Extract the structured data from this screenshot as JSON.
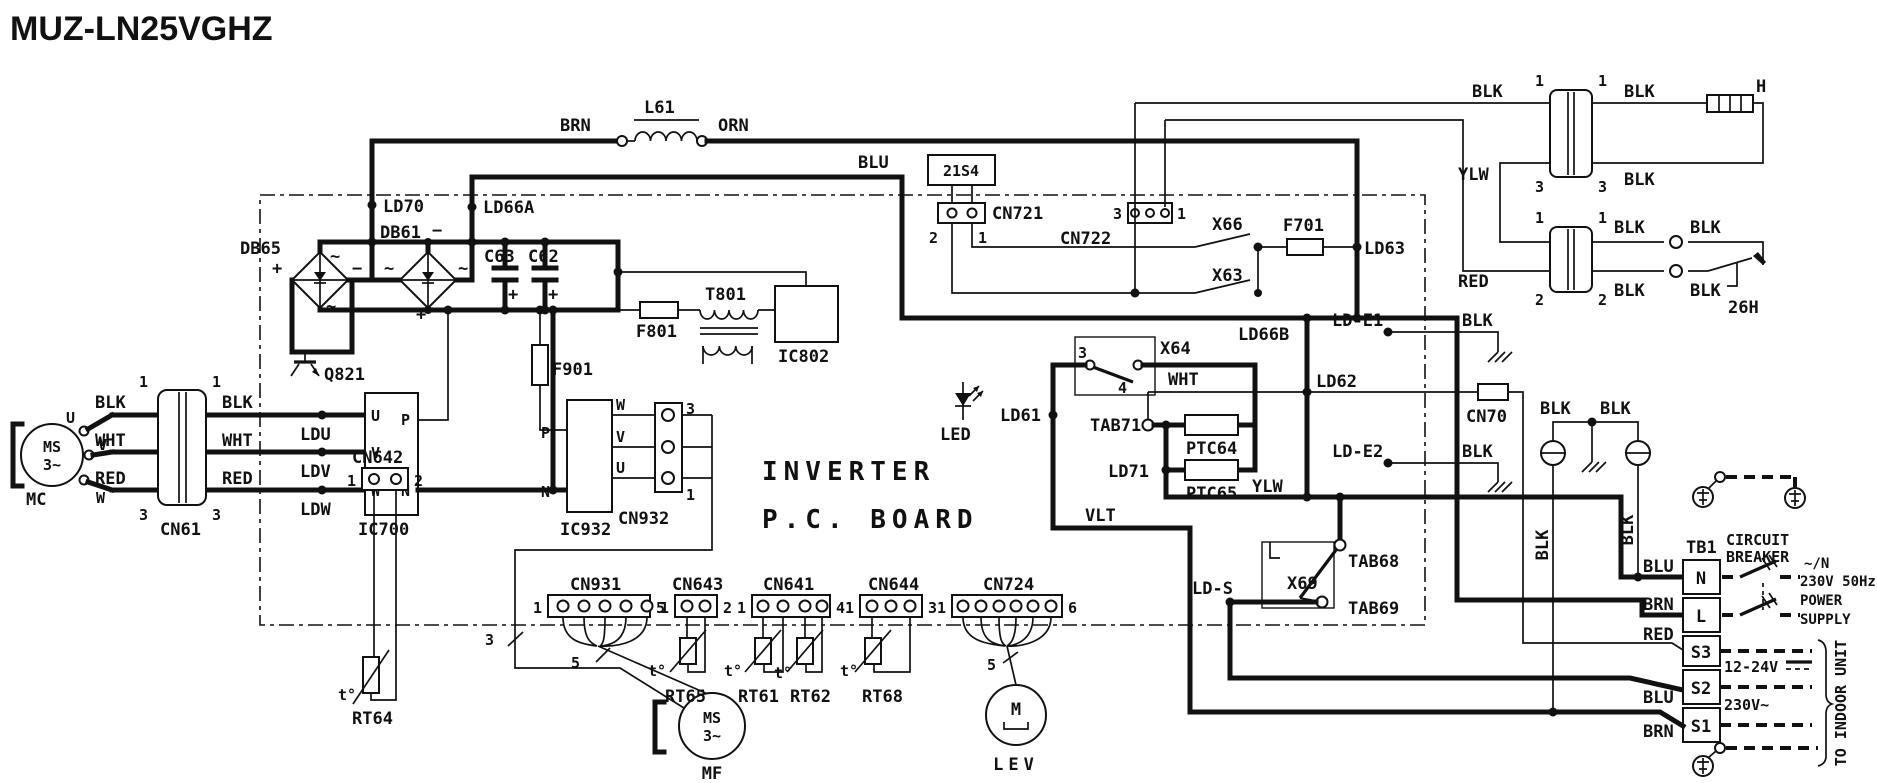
{
  "title": "MUZ-LN25VGHZ",
  "board": {
    "line1": "INVERTER",
    "line2": "P.C. BOARD"
  },
  "wires": {
    "blk": "BLK",
    "wht": "WHT",
    "red": "RED",
    "brn": "BRN",
    "orn": "ORN",
    "blu": "BLU",
    "ylw": "YLW",
    "vlt": "VLT"
  },
  "pins": {
    "p1": "1",
    "p2": "2",
    "p3": "3",
    "p4": "4",
    "p5": "5",
    "p6": "6"
  },
  "sym": {
    "plus": "+",
    "minus": "−",
    "ac": "~",
    "u": "U",
    "v": "V",
    "w": "W",
    "p": "P",
    "n": "N",
    "t": "t°",
    "m": "M",
    "ms": "MS",
    "ph3": "3~"
  },
  "components": {
    "l61": "L61",
    "db65": "DB65",
    "db61": "DB61",
    "c63": "C63",
    "c62": "C62",
    "q821": "Q821",
    "f801": "F801",
    "t801": "T801",
    "ic802": "IC802",
    "f901": "F901",
    "ic700": "IC700",
    "ic932": "IC932",
    "led": "LED",
    "v21s4": "21S4",
    "x66": "X66",
    "x63": "X63",
    "x64": "X64",
    "x69": "X69",
    "f701": "F701",
    "ptc64": "PTC64",
    "ptc65": "PTC65",
    "tab71": "TAB71",
    "tab68": "TAB68",
    "tab69": "TAB69",
    "heater": "H",
    "h26": "26H",
    "mc": "MC",
    "mf": "MF",
    "lev": "LEV"
  },
  "testpoints": {
    "ld70": "LD70",
    "ld66a": "LD66A",
    "ld66b": "LD66B",
    "ld61": "LD61",
    "ld62": "LD62",
    "ld63": "LD63",
    "ld71": "LD71",
    "ldu": "LDU",
    "ldv": "LDV",
    "ldw": "LDW",
    "lde1": "LD-E1",
    "lde2": "LD-E2",
    "lds": "LD-S"
  },
  "connectors": {
    "cn61": "CN61",
    "cn70": "CN70",
    "cn642": "CN642",
    "cn931": "CN931",
    "cn643": "CN643",
    "cn641": "CN641",
    "cn644": "CN644",
    "cn724": "CN724",
    "cn721": "CN721",
    "cn722": "CN722",
    "cn932": "CN932"
  },
  "thermistors": {
    "rt64": "RT64",
    "rt65": "RT65",
    "rt61": "RT61",
    "rt62": "RT62",
    "rt68": "RT68"
  },
  "tb": {
    "tb1": "TB1",
    "n": "N",
    "l": "L",
    "s3": "S3",
    "s2": "S2",
    "s1": "S1"
  },
  "power": {
    "circuit": "CIRCUIT",
    "breaker": "BREAKER",
    "phase": "~/N",
    "rating": "230V 50Hz",
    "power": "POWER",
    "supply": "SUPPLY",
    "sig": "12-24V",
    "mains": "230V~",
    "indoor": "TO INDOOR UNIT"
  }
}
